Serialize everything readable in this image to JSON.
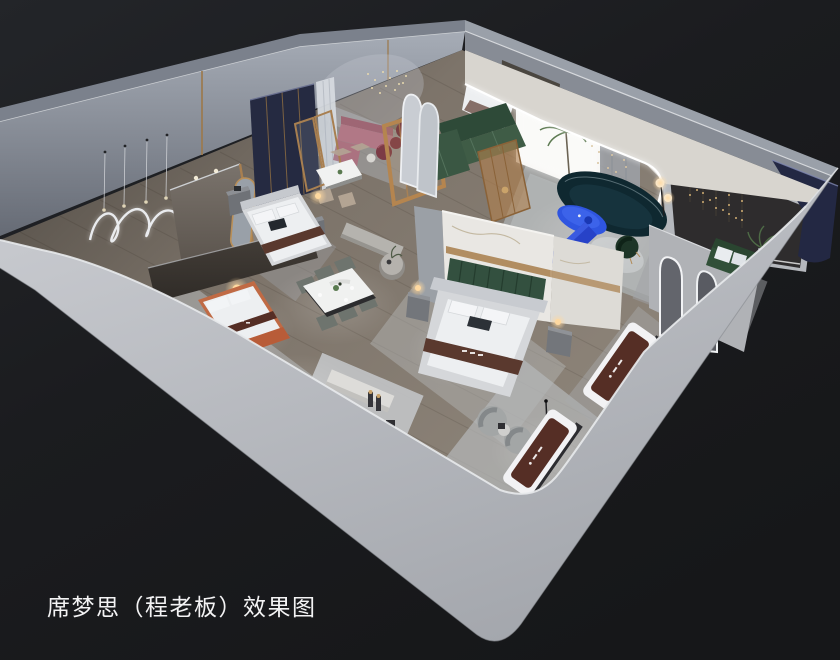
{
  "caption": {
    "text": "席梦思（程老板）效果图"
  },
  "colors": {
    "caption": "#f3f3f4",
    "bgTop": "#232529",
    "bgBottom": "#161719",
    "wallBandLight": "#cbcdd2",
    "wallBandDark": "#a4a7ad",
    "wallLip": "#e8eaec",
    "wallTopNW": "#7b818c",
    "wallFaceNW1": "#a6acb6",
    "wallFaceNW2": "#666b75",
    "wallTopNE": "#9aa0a9",
    "wallFaceNE": "#878c95",
    "cream": "#d8d5cf",
    "led": "#ffffff",
    "floorDark": "#4a453f",
    "floorMid": "#7d746a",
    "floorLight": "#8f867b",
    "rug": "#b5b8b9",
    "marble": "#e9e7e3",
    "gold": "#ab8352",
    "navyPanel": "#252a41",
    "navyWall": "#232843",
    "darkWall": "#2e2c2d",
    "taupe": "#7a736c",
    "green": "#3f5c46",
    "greenDark": "#2a4530",
    "teal": "#0f2830",
    "blue": "#2f55e0",
    "blue2": "#2742c8",
    "mauve": "#b17886",
    "burgundy": "#7c3b46",
    "terracotta": "#c06a44",
    "terracottaDeep": "#b85c38",
    "mattressBrown": "#552e25",
    "runnerBrown": "#5a392e",
    "bedWhite": "#edeff1",
    "platform": "#d5d7da",
    "glow": "#ffd9a0",
    "stringLight": "#d3af74",
    "plant": "#5a7a50",
    "boucle": "#a3a6a6",
    "mirror": "#9aa0a8"
  },
  "scene": {
    "objects": [
      "exterior-walls",
      "wood-floor",
      "area-rugs",
      "wall-art-squiggle",
      "pendant-lights",
      "bed-navy-headboard",
      "bed-terracotta",
      "bed-center",
      "marble-partition",
      "dining-table-large",
      "dining-table-small",
      "bench-console",
      "round-side-table",
      "green-sectional-sofa",
      "teal-curved-sofa",
      "blue-coffee-table",
      "blue-tv-console",
      "mauve-sofa",
      "burgundy-ottomans",
      "palm-plant",
      "white-light-backdrop",
      "dark-display-wall",
      "string-lights",
      "navy-corner-wall",
      "green-bench",
      "arch-mirrors",
      "wood-display-frame",
      "glass-brass-dividers",
      "mattress-displays",
      "boucle-armchairs",
      "floor-lamp",
      "table-lamp-glow"
    ]
  }
}
